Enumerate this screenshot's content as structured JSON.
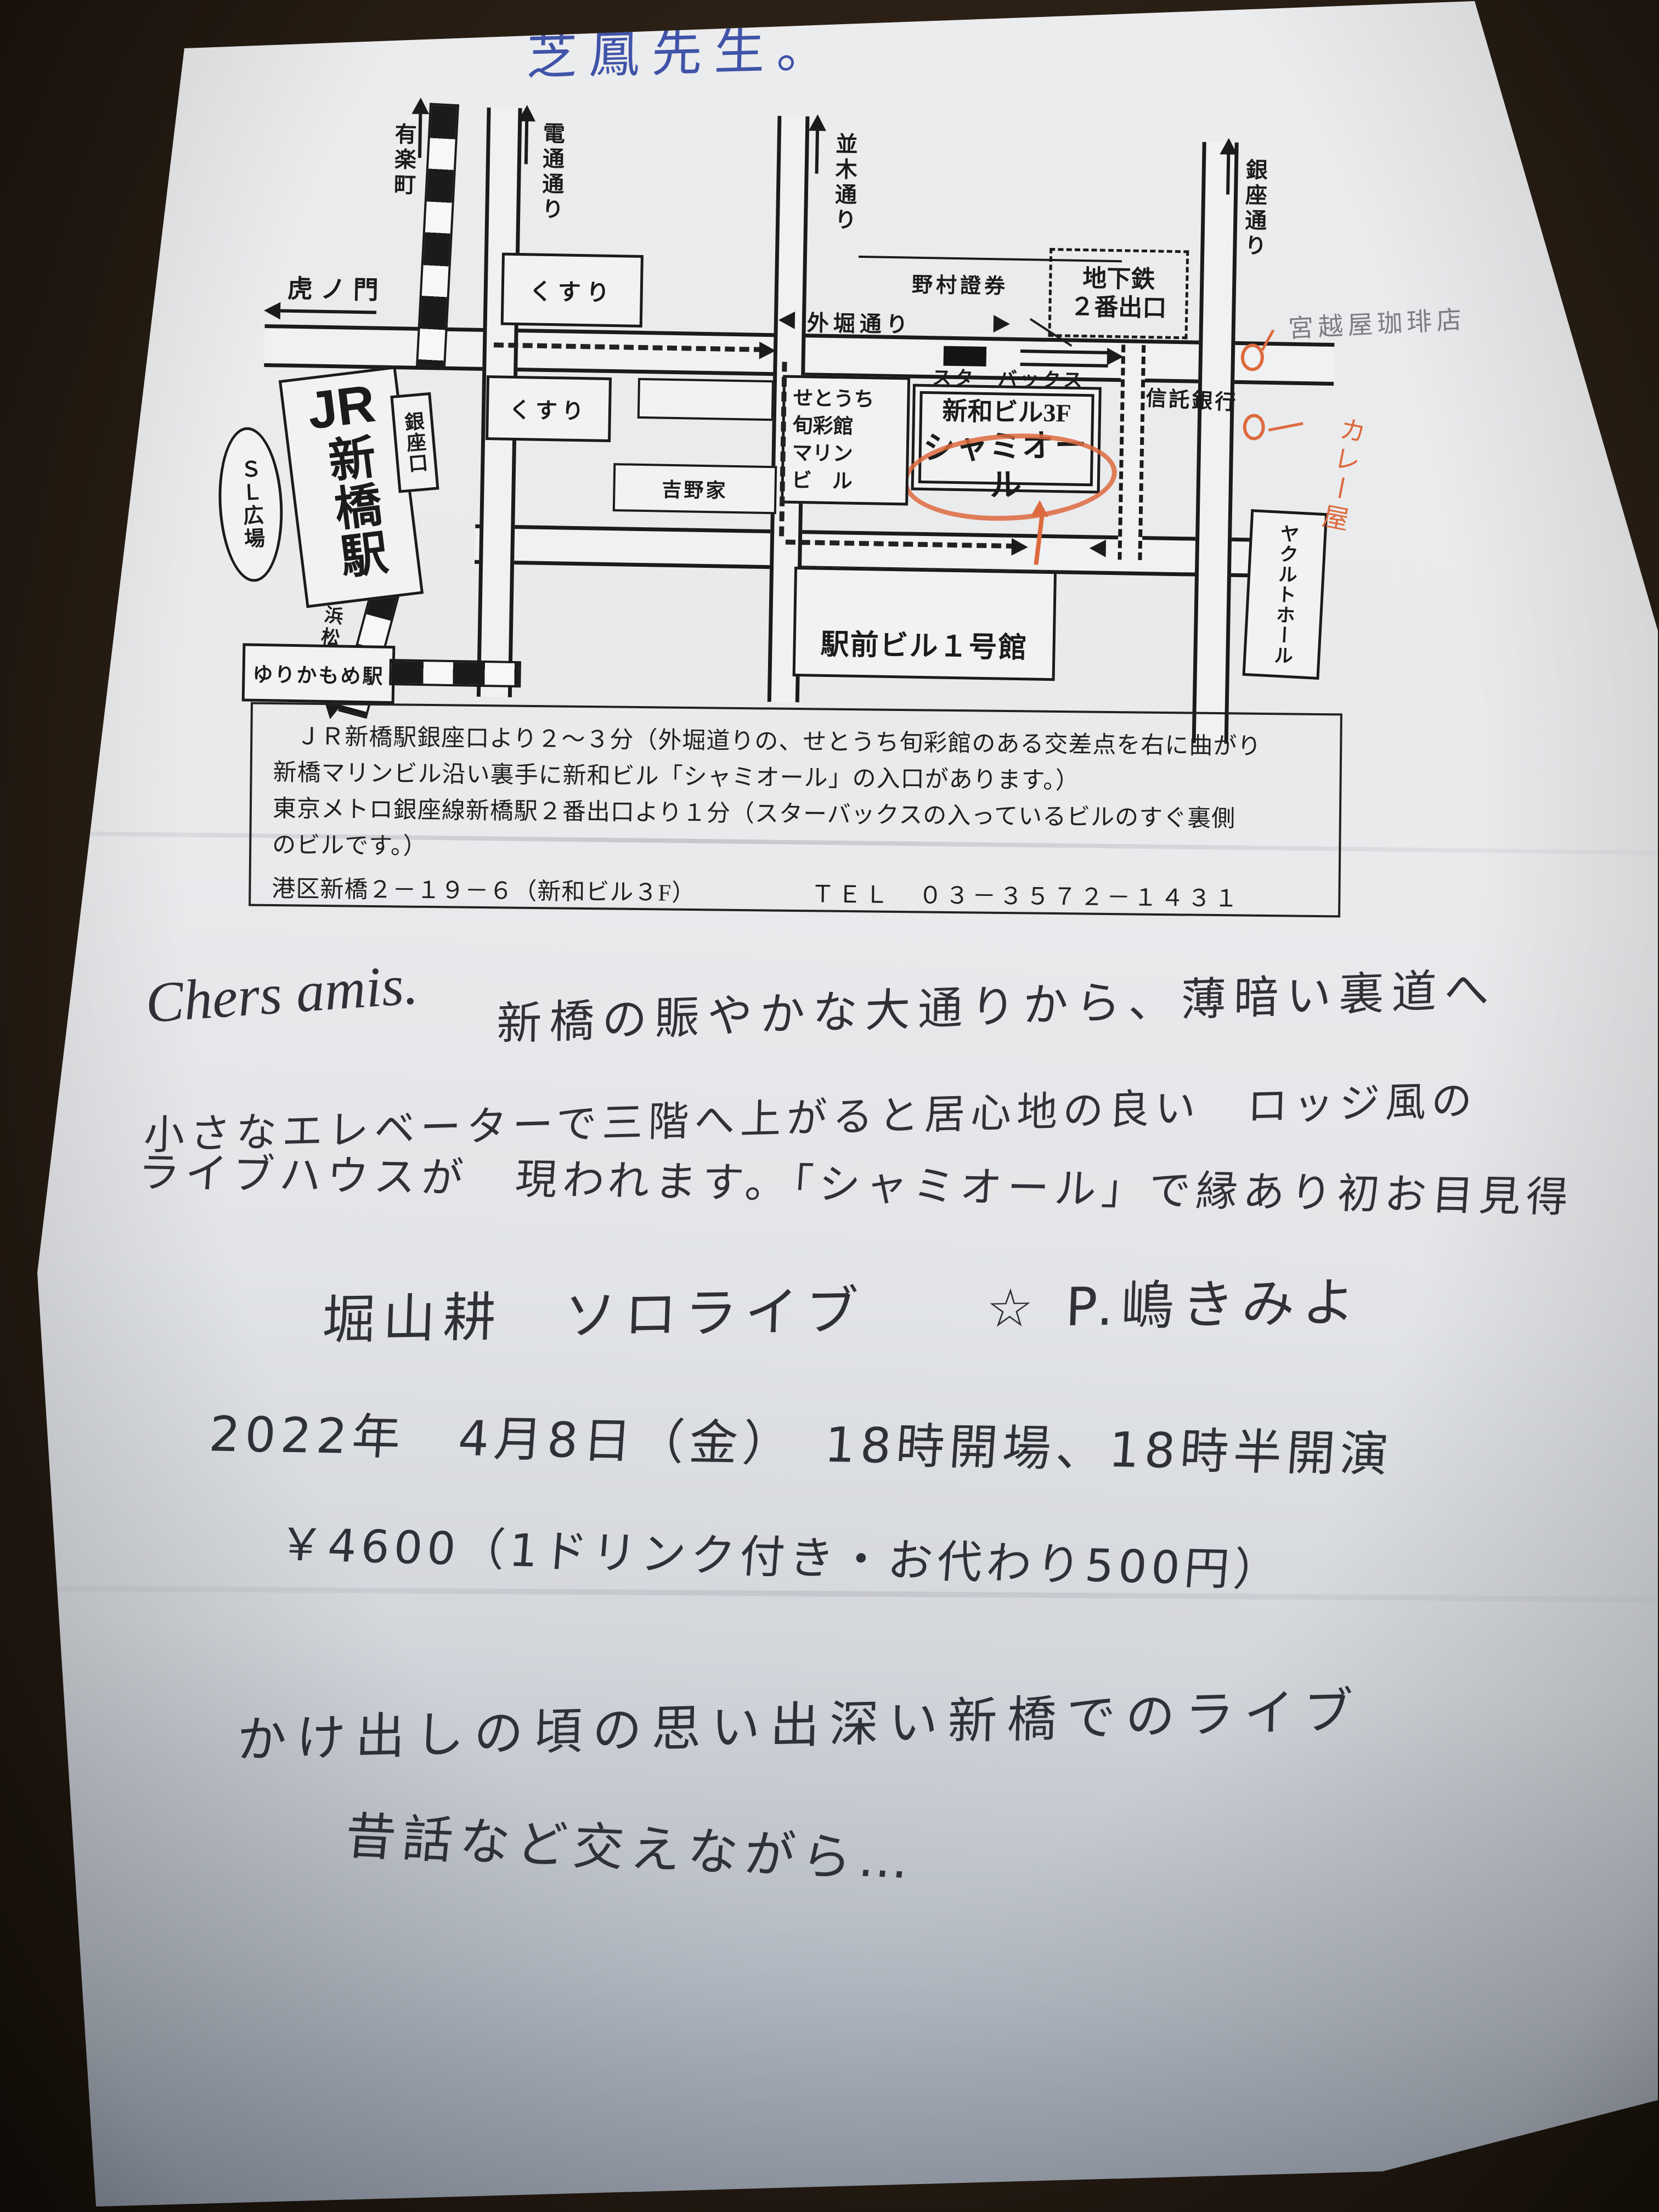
{
  "photo": {
    "background_color": "#2a1f15",
    "paper_color": "#e9eaec",
    "accent_orange": "#dd6a3e",
    "ink_blue": "#4053a8",
    "ink_black": "#303138",
    "pencil_gray": "#7d7d82",
    "print_red": "#c0392b"
  },
  "note_top": "芝鳳先生。",
  "map": {
    "yurakucho": "有楽町",
    "toranomon": "虎ノ門",
    "dentsu_dori": "電通通り",
    "namiki_dori": "並木通り",
    "ginza_dori": "銀座通り",
    "sotobori_dori": "外堀通り",
    "hamamatsucho": "浜松町",
    "jr_label": "JR",
    "shimbashi_station": "新橋駅",
    "ginza_exit": "銀座口",
    "sl_square": "ＳＬ広場",
    "yurikamome": "ゆりかもめ駅",
    "kusuri": "くすり",
    "yoshinoya": "吉野家",
    "nomura": "野村證券",
    "subway_exit_line1": "地下鉄",
    "subway_exit_line2": "２番出口",
    "setouchi_lines": [
      "せとうち",
      "旬彩館",
      "マリン",
      "ビ　ル"
    ],
    "starbucks": "スターバックス",
    "shinwa_bldg": "新和ビル3F",
    "chamiol": "シャミオール",
    "trust_bank": "信託銀行",
    "yakult_hall": "ヤクルトホール",
    "ekimae_bldg": "駅前ビル１号館",
    "coffee_note": "宮越屋珈琲店",
    "curry_note": "カレー屋"
  },
  "info_box": {
    "line1": "ＪＲ新橋駅銀座口より２～３分（外堀道りの、せとうち旬彩館のある交差点を右に曲がり",
    "line2": "新橋マリンビル沿い裏手に新和ビル「シャミオール」の入口があります。）",
    "line3": "東京メトロ銀座線新橋駅２番出口より１分（スターバックスの入っているビルのすぐ裏側",
    "line4": "のビルです。）",
    "address": "港区新橋２－１９－６（新和ビル３F）",
    "tel": "ＴＥＬ　０３－３５７２－１４３１"
  },
  "letter": {
    "salutation": "Chers amis.",
    "line1": "新橋の賑やかな大通りから、薄暗い裏道へ",
    "line2": "小さなエレベーターで三階へ上がると居心地の良い　ロッジ風の",
    "line3": "ライブハウスが　現われます。「シャミオール」で縁あり初お目見得",
    "artist_line": "堀山耕　ソロライブ　　☆ P.嶋きみよ",
    "date_line": "2022年　4月8日（金）　18時開場、18時半開演",
    "price_line": "￥4600（1ドリンク付き・お代わり500円）",
    "closing1": "かけ出しの頃の思い出深い新橋でのライブ",
    "closing2": "昔話など交えながら…"
  }
}
